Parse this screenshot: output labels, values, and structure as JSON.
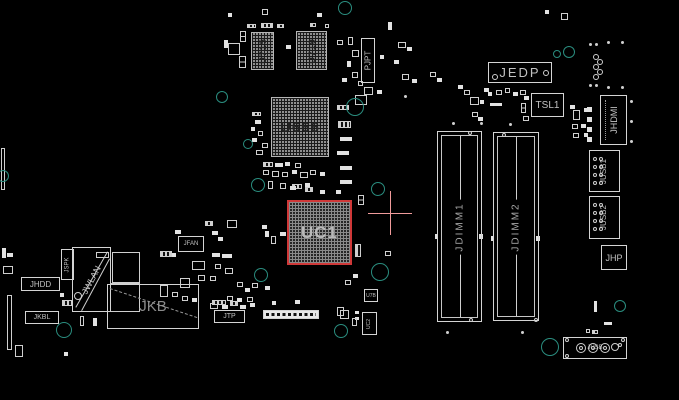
{
  "app": {
    "type": "pcb-boardview",
    "background": "#000000"
  },
  "selection": {
    "component": "UC1",
    "highlight_color": "#cf3838",
    "crosshair": {
      "x": 390,
      "y": 213,
      "arm": 22,
      "color": "#f09b9b"
    }
  },
  "colors": {
    "outline": "#d4d4d4",
    "fill": "#e2e2e2",
    "label": "#c2c2c2",
    "via": "#2a8d7f"
  },
  "chips": [
    {
      "label": "U715",
      "x": 251,
      "y": 32,
      "w": 23,
      "h": 38,
      "dir": "v",
      "fs": 9
    },
    {
      "label": "U719",
      "x": 296,
      "y": 31,
      "w": 31,
      "h": 39,
      "dir": "v",
      "fs": 9
    },
    {
      "label": "U666",
      "x": 271,
      "y": 97,
      "w": 58,
      "h": 60,
      "dir": "h",
      "fs": 15
    },
    {
      "label": "UC1",
      "x": 287,
      "y": 200,
      "w": 65,
      "h": 65,
      "dir": "h",
      "fs": 17,
      "selected": true
    }
  ],
  "dimm_slots": [
    {
      "label": "JDIMM1",
      "x": 437,
      "y": 131,
      "w": 45,
      "h": 191
    },
    {
      "label": "JDIMM2",
      "x": 493,
      "y": 132,
      "w": 46,
      "h": 189
    }
  ],
  "connectors": [
    {
      "label": "PJPT",
      "x": 361,
      "y": 38,
      "w": 14,
      "h": 45,
      "o": "v",
      "fs": 8
    },
    {
      "label": "JEDP",
      "x": 488,
      "y": 62,
      "w": 64,
      "h": 21,
      "o": "h",
      "fs": 13,
      "ls": 2
    },
    {
      "label": "TSL1",
      "x": 531,
      "y": 93,
      "w": 33,
      "h": 24,
      "o": "h",
      "fs": 10
    },
    {
      "label": "JHDMI",
      "x": 600,
      "y": 95,
      "w": 27,
      "h": 50,
      "o": "v",
      "fs": 9,
      "deco": "hdmi"
    },
    {
      "label": "JUSB1",
      "x": 589,
      "y": 150,
      "w": 31,
      "h": 42,
      "o": "v",
      "fs": 8,
      "deco": "usbgrid"
    },
    {
      "label": "JUSB2",
      "x": 589,
      "y": 196,
      "w": 31,
      "h": 43,
      "o": "v",
      "fs": 8,
      "deco": "usbgrid"
    },
    {
      "label": "JHP",
      "x": 601,
      "y": 245,
      "w": 26,
      "h": 25,
      "o": "h",
      "fs": 9
    },
    {
      "label": "JFAN",
      "x": 178,
      "y": 236,
      "w": 26,
      "h": 16,
      "o": "h",
      "fs": 6
    },
    {
      "label": "JSPK",
      "x": 61,
      "y": 249,
      "w": 13,
      "h": 31,
      "o": "v",
      "fs": 6
    },
    {
      "label": "JWLAN",
      "x": 72,
      "y": 247,
      "w": 39,
      "h": 65,
      "o": "d",
      "fs": 9
    },
    {
      "label": "JHDD",
      "x": 21,
      "y": 277,
      "w": 39,
      "h": 14,
      "o": "h",
      "fs": 8
    },
    {
      "label": "JKBL",
      "x": 25,
      "y": 311,
      "w": 34,
      "h": 13,
      "o": "h",
      "fs": 7
    },
    {
      "label": "JKB",
      "x": 107,
      "y": 284,
      "w": 92,
      "h": 45,
      "o": "h",
      "fs": 15,
      "dim": true
    },
    {
      "label": "JTP",
      "x": 214,
      "y": 310,
      "w": 31,
      "h": 13,
      "o": "h",
      "fs": 7
    },
    {
      "label": "JUSB",
      "x": 563,
      "y": 337,
      "w": 64,
      "h": 22,
      "o": "h",
      "fs": 6
    },
    {
      "label": "U7B",
      "x": 364,
      "y": 289,
      "w": 14,
      "h": 13,
      "o": "h",
      "fs": 5
    },
    {
      "label": "UC2",
      "x": 362,
      "y": 312,
      "w": 15,
      "h": 23,
      "o": "v",
      "fs": 5
    }
  ],
  "pin_header": {
    "x": 263,
    "y": 310,
    "w": 56,
    "h": 9
  },
  "jkb_dash": {
    "x1": 110,
    "y1": 288,
    "x2": 197,
    "y2": 317
  },
  "jwlan_lines": [
    [
      108,
      252,
      76,
      308
    ],
    [
      110,
      259,
      82,
      311
    ]
  ],
  "jusb_pins": {
    "outer": [
      [
        581,
        348,
        5
      ],
      [
        593,
        348,
        5
      ],
      [
        605,
        348,
        5
      ],
      [
        615,
        347,
        4
      ]
    ],
    "inner": [
      [
        581,
        348,
        2
      ],
      [
        593,
        348,
        2
      ],
      [
        605,
        348,
        2
      ]
    ]
  },
  "vias": [
    [
      345,
      8,
      7
    ],
    [
      222,
      97,
      6
    ],
    [
      355,
      107,
      9
    ],
    [
      248,
      144,
      5
    ],
    [
      258,
      185,
      7
    ],
    [
      378,
      189,
      7
    ],
    [
      380,
      272,
      9
    ],
    [
      261,
      275,
      7
    ],
    [
      341,
      331,
      7
    ],
    [
      550,
      347,
      9
    ],
    [
      620,
      306,
      6
    ],
    [
      557,
      54,
      4
    ],
    [
      569,
      52,
      6
    ],
    [
      64,
      330,
      8
    ],
    [
      3,
      176,
      6
    ]
  ],
  "white_circles": [
    [
      596,
      57,
      3
    ],
    [
      600,
      62,
      3
    ],
    [
      596,
      67,
      3
    ],
    [
      600,
      72,
      3
    ],
    [
      596,
      77,
      3
    ],
    [
      470,
      133,
      2
    ],
    [
      471,
      320,
      2
    ],
    [
      504,
      135,
      2
    ],
    [
      536,
      320,
      2
    ],
    [
      495,
      77,
      3
    ],
    [
      546,
      73,
      3
    ],
    [
      78,
      296,
      4
    ],
    [
      567,
      340,
      2
    ],
    [
      623,
      340,
      2
    ],
    [
      567,
      356,
      2
    ],
    [
      620,
      345,
      2
    ]
  ],
  "dots": [
    [
      589,
      43
    ],
    [
      595,
      43
    ],
    [
      607,
      41
    ],
    [
      621,
      41
    ],
    [
      589,
      84
    ],
    [
      595,
      84
    ],
    [
      607,
      86
    ],
    [
      621,
      86
    ],
    [
      630,
      100
    ],
    [
      630,
      120
    ],
    [
      630,
      140
    ],
    [
      452,
      122
    ],
    [
      480,
      122
    ],
    [
      509,
      123
    ],
    [
      446,
      331
    ],
    [
      521,
      331
    ],
    [
      404,
      95
    ]
  ],
  "passives": [
    [
      228,
      13,
      4,
      4,
      "f"
    ],
    [
      262,
      9,
      6,
      6,
      "o"
    ],
    [
      317,
      13,
      5,
      4,
      "f"
    ],
    [
      247,
      24,
      9,
      4,
      "h"
    ],
    [
      261,
      23,
      12,
      5,
      "h"
    ],
    [
      277,
      24,
      7,
      4,
      "h"
    ],
    [
      310,
      23,
      6,
      4,
      "h"
    ],
    [
      325,
      24,
      4,
      4,
      "o"
    ],
    [
      224,
      40,
      4,
      8,
      "f"
    ],
    [
      228,
      43,
      12,
      12,
      "o"
    ],
    [
      240,
      31,
      6,
      11,
      "o2"
    ],
    [
      239,
      56,
      7,
      12,
      "o2"
    ],
    [
      286,
      45,
      5,
      4,
      "f"
    ],
    [
      337,
      40,
      6,
      5,
      "o"
    ],
    [
      348,
      37,
      5,
      8,
      "o"
    ],
    [
      352,
      50,
      7,
      7,
      "o"
    ],
    [
      347,
      61,
      4,
      6,
      "f"
    ],
    [
      352,
      72,
      6,
      6,
      "o"
    ],
    [
      342,
      78,
      5,
      4,
      "f"
    ],
    [
      358,
      81,
      5,
      5,
      "o"
    ],
    [
      364,
      87,
      9,
      8,
      "o"
    ],
    [
      377,
      90,
      5,
      4,
      "f"
    ],
    [
      355,
      95,
      12,
      10,
      "o"
    ],
    [
      380,
      55,
      4,
      4,
      "f"
    ],
    [
      388,
      22,
      4,
      8,
      "f"
    ],
    [
      394,
      60,
      5,
      4,
      "f"
    ],
    [
      402,
      74,
      7,
      6,
      "o"
    ],
    [
      412,
      79,
      5,
      4,
      "f"
    ],
    [
      398,
      42,
      8,
      6,
      "o"
    ],
    [
      407,
      47,
      5,
      4,
      "f"
    ],
    [
      430,
      72,
      6,
      5,
      "o"
    ],
    [
      437,
      78,
      5,
      4,
      "f"
    ],
    [
      458,
      85,
      5,
      4,
      "f"
    ],
    [
      464,
      90,
      6,
      5,
      "o"
    ],
    [
      252,
      112,
      9,
      4,
      "h"
    ],
    [
      255,
      120,
      6,
      4,
      "f"
    ],
    [
      251,
      127,
      4,
      4,
      "f"
    ],
    [
      258,
      131,
      5,
      5,
      "o"
    ],
    [
      252,
      138,
      5,
      4,
      "f"
    ],
    [
      262,
      143,
      6,
      5,
      "o"
    ],
    [
      256,
      150,
      7,
      5,
      "o"
    ],
    [
      337,
      105,
      12,
      5,
      "h"
    ],
    [
      338,
      121,
      13,
      7,
      "h"
    ],
    [
      340,
      137,
      12,
      4,
      "f"
    ],
    [
      337,
      151,
      12,
      4,
      "f"
    ],
    [
      340,
      166,
      12,
      4,
      "f"
    ],
    [
      340,
      180,
      12,
      4,
      "f"
    ],
    [
      263,
      162,
      10,
      5,
      "h"
    ],
    [
      275,
      163,
      8,
      4,
      "f"
    ],
    [
      285,
      162,
      5,
      4,
      "f"
    ],
    [
      295,
      163,
      6,
      5,
      "o"
    ],
    [
      263,
      170,
      6,
      5,
      "o"
    ],
    [
      272,
      171,
      7,
      6,
      "o"
    ],
    [
      282,
      172,
      6,
      5,
      "o"
    ],
    [
      292,
      170,
      5,
      4,
      "f"
    ],
    [
      300,
      172,
      8,
      6,
      "o"
    ],
    [
      310,
      170,
      6,
      5,
      "o"
    ],
    [
      320,
      172,
      5,
      4,
      "f"
    ],
    [
      268,
      181,
      5,
      8,
      "o"
    ],
    [
      280,
      183,
      6,
      6,
      "o"
    ],
    [
      292,
      184,
      10,
      5,
      "h"
    ],
    [
      305,
      183,
      5,
      4,
      "f"
    ],
    [
      305,
      187,
      8,
      5,
      "h"
    ],
    [
      290,
      186,
      6,
      4,
      "f"
    ],
    [
      320,
      190,
      5,
      4,
      "f"
    ],
    [
      336,
      190,
      5,
      4,
      "f"
    ],
    [
      358,
      195,
      6,
      10,
      "o2"
    ],
    [
      355,
      244,
      6,
      13,
      "h"
    ],
    [
      385,
      251,
      6,
      5,
      "o"
    ],
    [
      205,
      221,
      8,
      5,
      "h"
    ],
    [
      227,
      220,
      10,
      8,
      "o"
    ],
    [
      262,
      225,
      5,
      4,
      "f"
    ],
    [
      175,
      230,
      6,
      4,
      "f"
    ],
    [
      212,
      231,
      6,
      4,
      "f"
    ],
    [
      218,
      237,
      5,
      4,
      "f"
    ],
    [
      265,
      231,
      4,
      6,
      "f"
    ],
    [
      271,
      236,
      5,
      8,
      "o"
    ],
    [
      280,
      232,
      6,
      4,
      "f"
    ],
    [
      172,
      253,
      4,
      4,
      "f"
    ],
    [
      212,
      253,
      8,
      4,
      "f"
    ],
    [
      222,
      254,
      10,
      4,
      "f"
    ],
    [
      160,
      251,
      12,
      6,
      "h"
    ],
    [
      192,
      261,
      13,
      9,
      "o"
    ],
    [
      215,
      264,
      6,
      5,
      "o"
    ],
    [
      225,
      268,
      8,
      6,
      "o"
    ],
    [
      180,
      278,
      10,
      10,
      "o"
    ],
    [
      198,
      275,
      7,
      6,
      "o"
    ],
    [
      210,
      276,
      6,
      5,
      "o"
    ],
    [
      237,
      282,
      6,
      5,
      "o"
    ],
    [
      245,
      288,
      5,
      4,
      "f"
    ],
    [
      252,
      283,
      6,
      5,
      "o"
    ],
    [
      265,
      286,
      5,
      4,
      "f"
    ],
    [
      160,
      285,
      8,
      12,
      "o"
    ],
    [
      172,
      292,
      6,
      5,
      "o"
    ],
    [
      182,
      296,
      6,
      5,
      "o"
    ],
    [
      192,
      298,
      5,
      4,
      "f"
    ],
    [
      227,
      296,
      6,
      5,
      "o"
    ],
    [
      237,
      298,
      5,
      4,
      "f"
    ],
    [
      247,
      297,
      6,
      5,
      "o"
    ],
    [
      210,
      303,
      8,
      6,
      "o"
    ],
    [
      222,
      305,
      6,
      4,
      "f"
    ],
    [
      212,
      300,
      14,
      5,
      "h"
    ],
    [
      230,
      301,
      8,
      5,
      "h"
    ],
    [
      240,
      305,
      6,
      4,
      "f"
    ],
    [
      250,
      303,
      5,
      4,
      "f"
    ],
    [
      272,
      301,
      4,
      4,
      "f"
    ],
    [
      295,
      300,
      5,
      4,
      "f"
    ],
    [
      337,
      307,
      7,
      9,
      "o"
    ],
    [
      355,
      311,
      4,
      3,
      "f"
    ],
    [
      355,
      317,
      4,
      3,
      "f"
    ],
    [
      345,
      280,
      6,
      5,
      "o"
    ],
    [
      353,
      274,
      5,
      4,
      "f"
    ],
    [
      340,
      310,
      9,
      9,
      "o"
    ],
    [
      352,
      318,
      5,
      8,
      "o"
    ],
    [
      2,
      248,
      4,
      10,
      "f"
    ],
    [
      7,
      253,
      6,
      4,
      "f"
    ],
    [
      3,
      266,
      10,
      8,
      "o"
    ],
    [
      7,
      295,
      5,
      55,
      "o"
    ],
    [
      1,
      148,
      4,
      42,
      "o"
    ],
    [
      60,
      293,
      4,
      4,
      "f"
    ],
    [
      62,
      300,
      10,
      6,
      "h"
    ],
    [
      80,
      316,
      4,
      10,
      "o"
    ],
    [
      93,
      318,
      4,
      8,
      "f"
    ],
    [
      15,
      345,
      8,
      12,
      "o"
    ],
    [
      64,
      352,
      4,
      4,
      "f"
    ],
    [
      112,
      252,
      28,
      31,
      "o"
    ],
    [
      110,
      283,
      30,
      29,
      "o"
    ],
    [
      96,
      252,
      13,
      6,
      "o"
    ],
    [
      484,
      88,
      5,
      4,
      "f"
    ],
    [
      488,
      92,
      4,
      4,
      "f"
    ],
    [
      496,
      90,
      6,
      5,
      "o"
    ],
    [
      505,
      88,
      5,
      5,
      "o"
    ],
    [
      513,
      92,
      5,
      4,
      "f"
    ],
    [
      520,
      90,
      6,
      5,
      "o"
    ],
    [
      524,
      96,
      5,
      4,
      "f"
    ],
    [
      470,
      97,
      9,
      8,
      "o"
    ],
    [
      480,
      100,
      4,
      4,
      "f"
    ],
    [
      490,
      103,
      12,
      3,
      "f"
    ],
    [
      472,
      112,
      6,
      5,
      "o"
    ],
    [
      478,
      117,
      5,
      4,
      "f"
    ],
    [
      521,
      103,
      5,
      10,
      "o2"
    ],
    [
      523,
      116,
      6,
      5,
      "o"
    ],
    [
      570,
      105,
      5,
      4,
      "f"
    ],
    [
      573,
      110,
      7,
      10,
      "o"
    ],
    [
      584,
      108,
      5,
      4,
      "f"
    ],
    [
      572,
      124,
      6,
      5,
      "o"
    ],
    [
      581,
      124,
      5,
      4,
      "f"
    ],
    [
      573,
      133,
      6,
      5,
      "o"
    ],
    [
      584,
      133,
      4,
      4,
      "f"
    ],
    [
      587,
      107,
      5,
      5,
      "f"
    ],
    [
      587,
      117,
      5,
      5,
      "f"
    ],
    [
      587,
      127,
      5,
      5,
      "f"
    ],
    [
      587,
      137,
      5,
      5,
      "f"
    ],
    [
      561,
      13,
      7,
      7,
      "o"
    ],
    [
      545,
      10,
      4,
      4,
      "f"
    ],
    [
      594,
      301,
      3,
      11,
      "f"
    ],
    [
      586,
      329,
      4,
      4,
      "o"
    ],
    [
      592,
      330,
      6,
      4,
      "h"
    ],
    [
      604,
      322,
      8,
      3,
      "f"
    ],
    [
      435,
      234,
      3,
      5,
      "f"
    ],
    [
      479,
      234,
      4,
      5,
      "f"
    ],
    [
      491,
      236,
      3,
      5,
      "f"
    ],
    [
      536,
      236,
      4,
      5,
      "f"
    ]
  ]
}
